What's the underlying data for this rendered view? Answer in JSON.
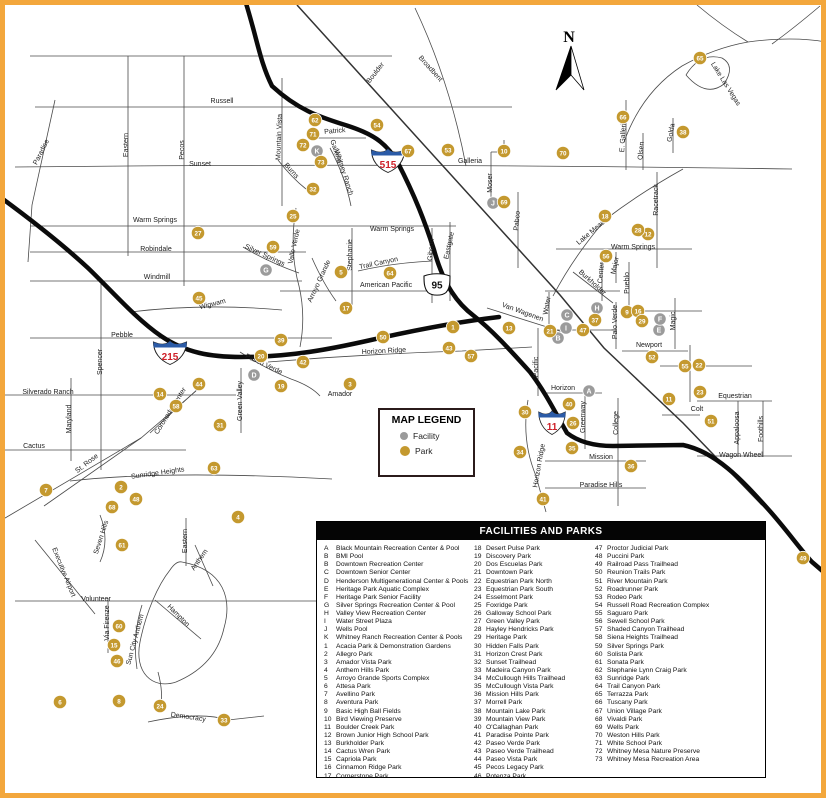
{
  "frame": {
    "border_color": "#F3A73C"
  },
  "compass": {
    "label": "N"
  },
  "colors": {
    "park": "#C4992F",
    "facility": "#9B9B9B",
    "road": "#4a4a4a",
    "highway": "#0b0b0b",
    "shield_red": "#CE2029",
    "shield_blue": "#2B5BA7"
  },
  "map_legend": {
    "title": "MAP LEGEND",
    "items": [
      {
        "label": "Facility",
        "type": "facility"
      },
      {
        "label": "Park",
        "type": "park"
      }
    ]
  },
  "shields": [
    {
      "kind": "interstate",
      "label": "215",
      "x": 170,
      "y": 352
    },
    {
      "kind": "interstate",
      "label": "515",
      "x": 388,
      "y": 160
    },
    {
      "kind": "us",
      "label": "95",
      "x": 437,
      "y": 285
    },
    {
      "kind": "interstate",
      "label": "11",
      "x": 552,
      "y": 422
    }
  ],
  "street_labels": [
    {
      "t": "Russell",
      "x": 222,
      "y": 103,
      "a": 0
    },
    {
      "t": "Sunset",
      "x": 200,
      "y": 166,
      "a": 0
    },
    {
      "t": "Galleria",
      "x": 470,
      "y": 163,
      "a": 0
    },
    {
      "t": "Warm Springs",
      "x": 155,
      "y": 222,
      "a": 0
    },
    {
      "t": "Warm Springs",
      "x": 392,
      "y": 231,
      "a": 0
    },
    {
      "t": "Warm Springs",
      "x": 633,
      "y": 249,
      "a": 0
    },
    {
      "t": "Robindale",
      "x": 156,
      "y": 251,
      "a": 0
    },
    {
      "t": "Windmill",
      "x": 157,
      "y": 279,
      "a": 0
    },
    {
      "t": "Wigwam",
      "x": 213,
      "y": 306,
      "a": -14
    },
    {
      "t": "Pebble",
      "x": 122,
      "y": 337,
      "a": 0
    },
    {
      "t": "Silverado Ranch",
      "x": 48,
      "y": 394,
      "a": 0
    },
    {
      "t": "Cactus",
      "x": 34,
      "y": 448,
      "a": 0
    },
    {
      "t": "Sunridge Heights",
      "x": 158,
      "y": 475,
      "a": -8
    },
    {
      "t": "Volunteer",
      "x": 96,
      "y": 601,
      "a": 0
    },
    {
      "t": "Democracy",
      "x": 188,
      "y": 719,
      "a": 8
    },
    {
      "t": "American Pacific",
      "x": 386,
      "y": 287,
      "a": 0
    },
    {
      "t": "Horizon Ridge",
      "x": 384,
      "y": 353,
      "a": -3
    },
    {
      "t": "Amador",
      "x": 340,
      "y": 396,
      "a": 0
    },
    {
      "t": "Newport",
      "x": 649,
      "y": 347,
      "a": 0
    },
    {
      "t": "Horizon",
      "x": 563,
      "y": 390,
      "a": 0
    },
    {
      "t": "Mission",
      "x": 601,
      "y": 459,
      "a": 0
    },
    {
      "t": "Paradise Hills",
      "x": 601,
      "y": 487,
      "a": 0
    },
    {
      "t": "Equestrian",
      "x": 735,
      "y": 398,
      "a": 0
    },
    {
      "t": "Colt",
      "x": 697,
      "y": 411,
      "a": 0
    },
    {
      "t": "Wagon Wheel",
      "x": 741,
      "y": 457,
      "a": 0
    },
    {
      "t": "Patrick",
      "x": 335,
      "y": 133,
      "a": -5
    },
    {
      "t": "Paradise",
      "x": 43,
      "y": 153,
      "a": -63
    },
    {
      "t": "Eastern",
      "x": 128,
      "y": 145,
      "a": -90
    },
    {
      "t": "Pecos",
      "x": 184,
      "y": 150,
      "a": -90
    },
    {
      "t": "Spencer",
      "x": 102,
      "y": 362,
      "a": -90
    },
    {
      "t": "Maryland",
      "x": 71,
      "y": 419,
      "a": -90
    },
    {
      "t": "Mountain Vista",
      "x": 281,
      "y": 137,
      "a": -88
    },
    {
      "t": "Stephanie",
      "x": 352,
      "y": 255,
      "a": -90
    },
    {
      "t": "Gibson",
      "x": 433,
      "y": 250,
      "a": -85
    },
    {
      "t": "Eastgate",
      "x": 451,
      "y": 246,
      "a": -78
    },
    {
      "t": "Moser",
      "x": 492,
      "y": 183,
      "a": -90
    },
    {
      "t": "Pabco",
      "x": 519,
      "y": 221,
      "a": -85
    },
    {
      "t": "E. Galleria",
      "x": 625,
      "y": 136,
      "a": -87
    },
    {
      "t": "Olsen",
      "x": 643,
      "y": 151,
      "a": -85
    },
    {
      "t": "Golda",
      "x": 673,
      "y": 133,
      "a": -80
    },
    {
      "t": "Racetrack",
      "x": 658,
      "y": 200,
      "a": -90
    },
    {
      "t": "Lake Las Vegas",
      "x": 724,
      "y": 85,
      "a": 58
    },
    {
      "t": "Lake Mead",
      "x": 592,
      "y": 234,
      "a": -40
    },
    {
      "t": "Boulder",
      "x": 377,
      "y": 74,
      "a": -52
    },
    {
      "t": "Broadbent",
      "x": 429,
      "y": 70,
      "a": 48
    },
    {
      "t": "Van Wagenen",
      "x": 522,
      "y": 314,
      "a": 20
    },
    {
      "t": "Water",
      "x": 549,
      "y": 306,
      "a": -80
    },
    {
      "t": "Burkholder",
      "x": 591,
      "y": 284,
      "a": 42
    },
    {
      "t": "Center",
      "x": 603,
      "y": 273,
      "a": -85
    },
    {
      "t": "Major",
      "x": 617,
      "y": 266,
      "a": -78
    },
    {
      "t": "Pueblo",
      "x": 629,
      "y": 283,
      "a": -90
    },
    {
      "t": "Palo Verde",
      "x": 617,
      "y": 322,
      "a": -90
    },
    {
      "t": "Magic",
      "x": 675,
      "y": 321,
      "a": -90
    },
    {
      "t": "Greenway",
      "x": 585,
      "y": 417,
      "a": -90
    },
    {
      "t": "College",
      "x": 618,
      "y": 423,
      "a": -90
    },
    {
      "t": "Horizon Ridge",
      "x": 541,
      "y": 466,
      "a": -80
    },
    {
      "t": "Pacific",
      "x": 538,
      "y": 367,
      "a": -90
    },
    {
      "t": "Appaloosa",
      "x": 739,
      "y": 428,
      "a": -90
    },
    {
      "t": "Foothills",
      "x": 763,
      "y": 429,
      "a": -90
    },
    {
      "t": "Green Valley",
      "x": 242,
      "y": 401,
      "a": -90
    },
    {
      "t": "Coronado Center",
      "x": 172,
      "y": 412,
      "a": -58
    },
    {
      "t": "St. Rose",
      "x": 88,
      "y": 465,
      "a": -38
    },
    {
      "t": "Seven Hills",
      "x": 103,
      "y": 538,
      "a": -72
    },
    {
      "t": "Executive Airport",
      "x": 62,
      "y": 573,
      "a": 68
    },
    {
      "t": "Sun City Anthem",
      "x": 137,
      "y": 640,
      "a": -75
    },
    {
      "t": "Via Firenze",
      "x": 109,
      "y": 623,
      "a": -90
    },
    {
      "t": "Hampton",
      "x": 177,
      "y": 617,
      "a": 45
    },
    {
      "t": "Eastern",
      "x": 187,
      "y": 541,
      "a": -90
    },
    {
      "t": "Anthem",
      "x": 201,
      "y": 561,
      "a": -55
    },
    {
      "t": "Whitney Ranch",
      "x": 342,
      "y": 173,
      "a": 72
    },
    {
      "t": "Galleria",
      "x": 334,
      "y": 152,
      "a": 72
    },
    {
      "t": "Burns",
      "x": 290,
      "y": 172,
      "a": 48
    },
    {
      "t": "Silver Springs",
      "x": 264,
      "y": 257,
      "a": 25
    },
    {
      "t": "Valle Verde",
      "x": 296,
      "y": 247,
      "a": -78
    },
    {
      "t": "Paseo Verde",
      "x": 263,
      "y": 366,
      "a": 25
    },
    {
      "t": "Arroyo Grande",
      "x": 321,
      "y": 282,
      "a": -65
    },
    {
      "t": "Trail Canyon",
      "x": 379,
      "y": 265,
      "a": -12
    }
  ],
  "facility_markers": [
    {
      "id": "A",
      "x": 589,
      "y": 391
    },
    {
      "id": "B",
      "x": 558,
      "y": 338
    },
    {
      "id": "C",
      "x": 567,
      "y": 315
    },
    {
      "id": "D",
      "x": 254,
      "y": 375
    },
    {
      "id": "E",
      "x": 659,
      "y": 330
    },
    {
      "id": "F",
      "x": 660,
      "y": 319
    },
    {
      "id": "G",
      "x": 266,
      "y": 270
    },
    {
      "id": "H",
      "x": 597,
      "y": 308
    },
    {
      "id": "I",
      "x": 566,
      "y": 328
    },
    {
      "id": "J",
      "x": 493,
      "y": 203
    },
    {
      "id": "K",
      "x": 317,
      "y": 151
    }
  ],
  "park_markers": [
    {
      "id": "1",
      "x": 453,
      "y": 327
    },
    {
      "id": "2",
      "x": 121,
      "y": 487
    },
    {
      "id": "3",
      "x": 350,
      "y": 384
    },
    {
      "id": "4",
      "x": 238,
      "y": 517
    },
    {
      "id": "5",
      "x": 341,
      "y": 272
    },
    {
      "id": "6",
      "x": 60,
      "y": 702
    },
    {
      "id": "7",
      "x": 46,
      "y": 490
    },
    {
      "id": "8",
      "x": 119,
      "y": 701
    },
    {
      "id": "9",
      "x": 627,
      "y": 312
    },
    {
      "id": "10",
      "x": 504,
      "y": 151
    },
    {
      "id": "11",
      "x": 669,
      "y": 399
    },
    {
      "id": "12",
      "x": 648,
      "y": 234
    },
    {
      "id": "13",
      "x": 509,
      "y": 328
    },
    {
      "id": "14",
      "x": 160,
      "y": 394
    },
    {
      "id": "15",
      "x": 114,
      "y": 645
    },
    {
      "id": "16",
      "x": 638,
      "y": 311
    },
    {
      "id": "17",
      "x": 346,
      "y": 308
    },
    {
      "id": "18",
      "x": 605,
      "y": 216
    },
    {
      "id": "19",
      "x": 281,
      "y": 386
    },
    {
      "id": "20",
      "x": 261,
      "y": 356
    },
    {
      "id": "21",
      "x": 550,
      "y": 331
    },
    {
      "id": "22",
      "x": 699,
      "y": 365
    },
    {
      "id": "23",
      "x": 700,
      "y": 392
    },
    {
      "id": "24",
      "x": 160,
      "y": 706
    },
    {
      "id": "25",
      "x": 293,
      "y": 216
    },
    {
      "id": "26",
      "x": 573,
      "y": 423
    },
    {
      "id": "27",
      "x": 198,
      "y": 233
    },
    {
      "id": "28",
      "x": 638,
      "y": 230
    },
    {
      "id": "29",
      "x": 642,
      "y": 321
    },
    {
      "id": "30",
      "x": 525,
      "y": 412
    },
    {
      "id": "31",
      "x": 220,
      "y": 425
    },
    {
      "id": "32",
      "x": 313,
      "y": 189
    },
    {
      "id": "33",
      "x": 224,
      "y": 720
    },
    {
      "id": "34",
      "x": 520,
      "y": 452
    },
    {
      "id": "35",
      "x": 572,
      "y": 448
    },
    {
      "id": "36",
      "x": 631,
      "y": 466
    },
    {
      "id": "37",
      "x": 595,
      "y": 320
    },
    {
      "id": "38",
      "x": 683,
      "y": 132
    },
    {
      "id": "39",
      "x": 281,
      "y": 340
    },
    {
      "id": "40",
      "x": 569,
      "y": 404
    },
    {
      "id": "41",
      "x": 543,
      "y": 499
    },
    {
      "id": "42",
      "x": 303,
      "y": 362
    },
    {
      "id": "43",
      "x": 449,
      "y": 348
    },
    {
      "id": "44",
      "x": 199,
      "y": 384
    },
    {
      "id": "45",
      "x": 199,
      "y": 298
    },
    {
      "id": "46",
      "x": 117,
      "y": 661
    },
    {
      "id": "47",
      "x": 583,
      "y": 330
    },
    {
      "id": "48",
      "x": 136,
      "y": 499
    },
    {
      "id": "49",
      "x": 803,
      "y": 558
    },
    {
      "id": "50",
      "x": 383,
      "y": 337
    },
    {
      "id": "51",
      "x": 711,
      "y": 421
    },
    {
      "id": "52",
      "x": 652,
      "y": 357
    },
    {
      "id": "53",
      "x": 448,
      "y": 150
    },
    {
      "id": "54",
      "x": 377,
      "y": 125
    },
    {
      "id": "55",
      "x": 685,
      "y": 366
    },
    {
      "id": "56",
      "x": 606,
      "y": 256
    },
    {
      "id": "57",
      "x": 471,
      "y": 356
    },
    {
      "id": "58",
      "x": 176,
      "y": 406
    },
    {
      "id": "59",
      "x": 273,
      "y": 247
    },
    {
      "id": "60",
      "x": 119,
      "y": 626
    },
    {
      "id": "61",
      "x": 122,
      "y": 545
    },
    {
      "id": "62",
      "x": 315,
      "y": 120
    },
    {
      "id": "63",
      "x": 214,
      "y": 468
    },
    {
      "id": "64",
      "x": 390,
      "y": 273
    },
    {
      "id": "65",
      "x": 700,
      "y": 58
    },
    {
      "id": "66",
      "x": 623,
      "y": 117
    },
    {
      "id": "67",
      "x": 408,
      "y": 151
    },
    {
      "id": "68",
      "x": 112,
      "y": 507
    },
    {
      "id": "69",
      "x": 504,
      "y": 202
    },
    {
      "id": "70",
      "x": 563,
      "y": 153
    },
    {
      "id": "71",
      "x": 313,
      "y": 134
    },
    {
      "id": "72",
      "x": 303,
      "y": 145
    },
    {
      "id": "73",
      "x": 321,
      "y": 162
    }
  ],
  "legend_table": {
    "title": "FACILITIES AND PARKS",
    "columns": [
      [
        {
          "k": "A",
          "v": "Black Mountain Recreation Center & Pool"
        },
        {
          "k": "B",
          "v": "BMI Pool"
        },
        {
          "k": "B",
          "v": "Downtown Recreation Center"
        },
        {
          "k": "C",
          "v": "Downtown Senior Center"
        },
        {
          "k": "D",
          "v": "Henderson Multigenerational Center & Pools"
        },
        {
          "k": "E",
          "v": "Heritage Park Aquatic Complex"
        },
        {
          "k": "F",
          "v": "Heritage Park Senior Facility"
        },
        {
          "k": "G",
          "v": "Silver Springs Recreation Center & Pool"
        },
        {
          "k": "H",
          "v": "Valley View Recreation Center"
        },
        {
          "k": "I",
          "v": "Water Street Plaza"
        },
        {
          "k": "J",
          "v": "Wells Pool"
        },
        {
          "k": "K",
          "v": "Whitney Ranch Recreation Center & Pools"
        },
        {
          "k": "1",
          "v": "Acacia Park & Demonstration Gardens"
        },
        {
          "k": "2",
          "v": "Allegro Park"
        },
        {
          "k": "3",
          "v": "Amador Vista Park"
        },
        {
          "k": "4",
          "v": "Anthem Hills Park"
        },
        {
          "k": "5",
          "v": "Arroyo Grande Sports Complex"
        },
        {
          "k": "6",
          "v": "Attesa Park"
        },
        {
          "k": "7",
          "v": "Avellino Park"
        },
        {
          "k": "8",
          "v": "Aventura Park"
        },
        {
          "k": "9",
          "v": "Basic High Ball Fields"
        },
        {
          "k": "10",
          "v": "Bird Viewing Preserve"
        },
        {
          "k": "11",
          "v": "Boulder Creek Park"
        },
        {
          "k": "12",
          "v": "Brown Junior High School Park"
        },
        {
          "k": "13",
          "v": "Burkholder Park"
        },
        {
          "k": "14",
          "v": "Cactus Wren Park"
        },
        {
          "k": "15",
          "v": "Capriola Park"
        },
        {
          "k": "16",
          "v": "Cinnamon Ridge Park"
        },
        {
          "k": "17",
          "v": "Cornerstone Park"
        }
      ],
      [
        {
          "k": "18",
          "v": "Desert Pulse Park"
        },
        {
          "k": "19",
          "v": "Discovery Park"
        },
        {
          "k": "20",
          "v": "Dos Escuelas Park"
        },
        {
          "k": "21",
          "v": "Downtown Park"
        },
        {
          "k": "22",
          "v": "Equestrian Park North"
        },
        {
          "k": "23",
          "v": "Equestrian Park South"
        },
        {
          "k": "24",
          "v": "Esselmont Park"
        },
        {
          "k": "25",
          "v": "Foxridge Park"
        },
        {
          "k": "26",
          "v": "Galloway School Park"
        },
        {
          "k": "27",
          "v": "Green Valley Park"
        },
        {
          "k": "28",
          "v": "Hayley Hendricks Park"
        },
        {
          "k": "29",
          "v": "Heritage Park"
        },
        {
          "k": "30",
          "v": "Hidden Falls Park"
        },
        {
          "k": "31",
          "v": "Horizon Crest Park"
        },
        {
          "k": "32",
          "v": "Sunset Trailhead"
        },
        {
          "k": "33",
          "v": "Madeira Canyon Park"
        },
        {
          "k": "34",
          "v": "McCullough Hills Trailhead"
        },
        {
          "k": "35",
          "v": "McCullough Vista Park"
        },
        {
          "k": "36",
          "v": "Mission Hills Park"
        },
        {
          "k": "37",
          "v": "Morrell Park"
        },
        {
          "k": "38",
          "v": "Mountain Lake Park"
        },
        {
          "k": "39",
          "v": "Mountain View Park"
        },
        {
          "k": "40",
          "v": "O'Callaghan Park"
        },
        {
          "k": "41",
          "v": "Paradise Pointe Park"
        },
        {
          "k": "42",
          "v": "Paseo Verde Park"
        },
        {
          "k": "43",
          "v": "Paseo Verde Trailhead"
        },
        {
          "k": "44",
          "v": "Paseo Vista Park"
        },
        {
          "k": "45",
          "v": "Pecos Legacy Park"
        },
        {
          "k": "46",
          "v": "Potenza Park"
        }
      ],
      [
        {
          "k": "47",
          "v": "Proctor Judicial Park"
        },
        {
          "k": "48",
          "v": "Puccini Park"
        },
        {
          "k": "49",
          "v": "Railroad Pass Trailhead"
        },
        {
          "k": "50",
          "v": "Reunion Trails Park"
        },
        {
          "k": "51",
          "v": "River Mountain Park"
        },
        {
          "k": "52",
          "v": "Roadrunner Park"
        },
        {
          "k": "53",
          "v": "Rodeo Park"
        },
        {
          "k": "54",
          "v": "Russell Road Recreation Complex"
        },
        {
          "k": "55",
          "v": "Saguaro Park"
        },
        {
          "k": "56",
          "v": "Sewell School Park"
        },
        {
          "k": "57",
          "v": "Shaded Canyon Trailhead"
        },
        {
          "k": "58",
          "v": "Siena Heights Trailhead"
        },
        {
          "k": "59",
          "v": "Silver Springs Park"
        },
        {
          "k": "60",
          "v": "Solista Park"
        },
        {
          "k": "61",
          "v": "Sonata Park"
        },
        {
          "k": "62",
          "v": "Stephanie Lynn Craig Park"
        },
        {
          "k": "63",
          "v": "Sunridge Park"
        },
        {
          "k": "64",
          "v": "Trail Canyon Park"
        },
        {
          "k": "65",
          "v": "Terrazza Park"
        },
        {
          "k": "66",
          "v": "Tuscany Park"
        },
        {
          "k": "67",
          "v": "Union Village Park"
        },
        {
          "k": "68",
          "v": "Vivaldi Park"
        },
        {
          "k": "69",
          "v": "Wells Park"
        },
        {
          "k": "70",
          "v": "Weston Hills Park"
        },
        {
          "k": "71",
          "v": "White School Park"
        },
        {
          "k": "72",
          "v": "Whitney Mesa Nature Preserve"
        },
        {
          "k": "73",
          "v": "Whitney Mesa Recreation Area"
        }
      ]
    ]
  }
}
